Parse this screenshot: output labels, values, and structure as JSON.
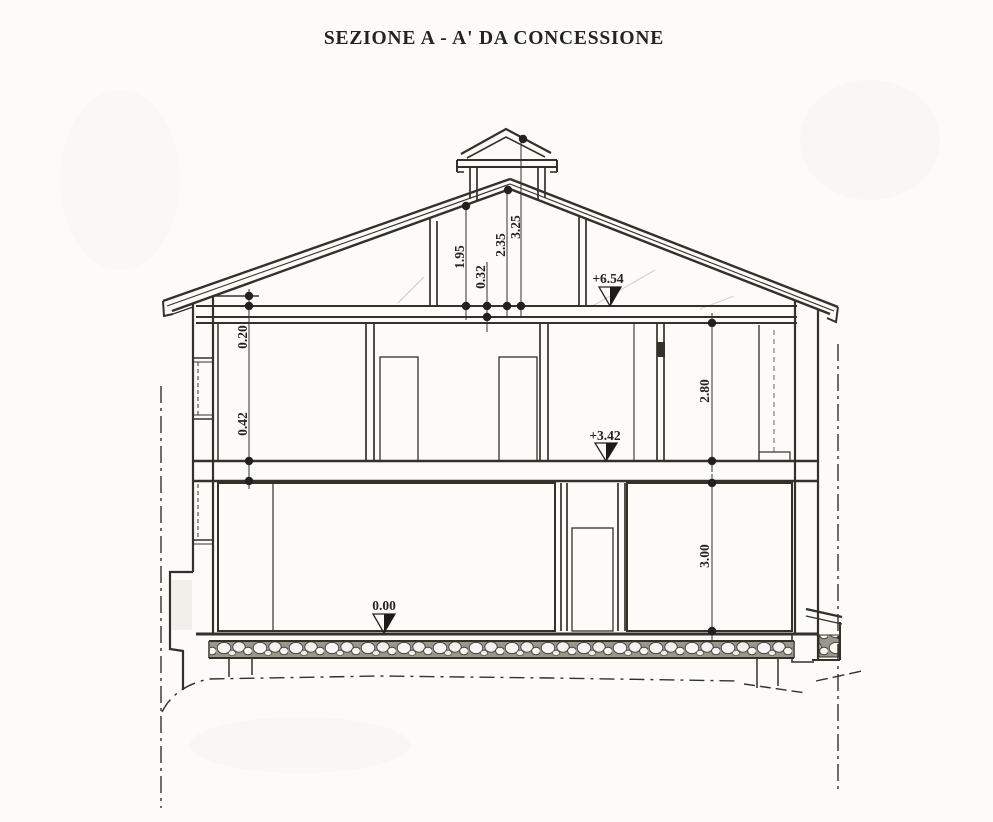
{
  "title": "SEZIONE A - A' DA CONCESSIONE",
  "dimensions": {
    "attic_height": "1.95",
    "attic_slab": "0.32",
    "ridge_height": "2.35",
    "chimney_height": "3.25",
    "eave_detail": "0.20",
    "floor_slab": "0.42",
    "first_floor_room_height": "2.80",
    "ground_floor_room_height": "3.00"
  },
  "levels": {
    "eaves": "+6.54",
    "first_floor": "+3.42",
    "ground_floor": "0.00"
  },
  "colors": {
    "ink": "#34302a",
    "paper": "#fcfbf8"
  }
}
